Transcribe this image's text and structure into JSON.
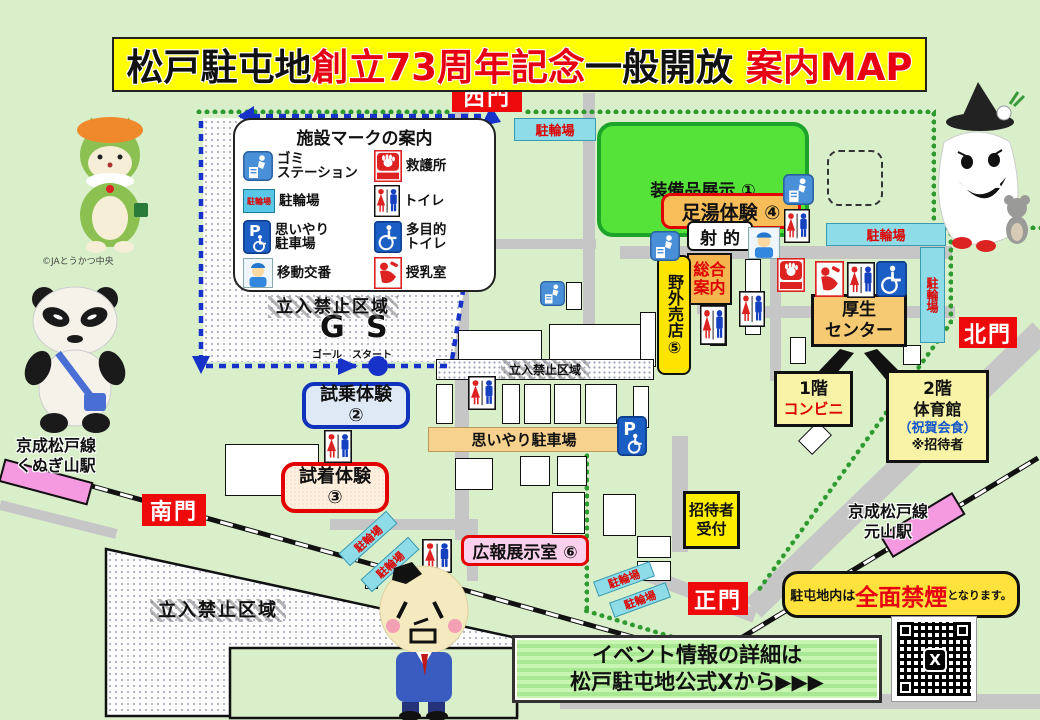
{
  "title": {
    "t1": "松戸駐屯地",
    "t2": "創立73周年記念",
    "t3": "一般開放",
    "t4": " 案内MAP"
  },
  "gates": {
    "west": "西門",
    "north": "北門",
    "south": "南門",
    "main": "正門"
  },
  "legend": {
    "title": "施設マークの案内",
    "items": [
      {
        "name": "trash-station",
        "label": "ゴミ\nステーション"
      },
      {
        "name": "first-aid",
        "label": "救護所"
      },
      {
        "name": "bicycle-parking",
        "label": "駐輪場"
      },
      {
        "name": "toilet",
        "label": "トイレ"
      },
      {
        "name": "priority-parking",
        "label": "思いやり\n駐車場"
      },
      {
        "name": "multipurpose-toilet",
        "label": "多目的\nトイレ"
      },
      {
        "name": "mobile-police",
        "label": "移動交番"
      },
      {
        "name": "nursing-room",
        "label": "授乳室"
      }
    ]
  },
  "venues": {
    "equipment_display": "装備品展示 ①",
    "test_ride": "試乗体験\n②",
    "fitting": "試着体験\n③",
    "foot_bath": "足湯体験 ④",
    "outdoor_shop": "野外売店⑤",
    "pr_exhibit": "広報展示室 ⑥",
    "shooting": "射 的",
    "info_desk": "総合\n案内",
    "welfare_center": "厚生\nセンター",
    "conv_line1": "1階",
    "conv_line2": "コンビニ",
    "gym_line1": "2階",
    "gym_line2": "体育館",
    "gym_line3": "（祝賀会食）",
    "gym_line4": "※招待者",
    "reception": "招待者\n受付",
    "priority_parking_strip": "思いやり駐車場"
  },
  "areas": {
    "restricted": "立入禁止区域",
    "bicycle": "駐輪場"
  },
  "course": {
    "goal": "G",
    "start": "S",
    "goal_label": "ゴール",
    "start_label": "スタート"
  },
  "stations": {
    "kunugiyama": "京成松戸線\nくぬぎ山駅",
    "motoyama": "京成松戸線\n元山駅"
  },
  "notices": {
    "smoke_pre": "駐屯地内は",
    "smoke_main": "全面禁煙",
    "smoke_post": "となります。",
    "event_line1": "イベント情報の詳細は",
    "event_line2": "松戸駐屯地公式Xから▶▶▶",
    "x_logo": "X"
  },
  "credits": {
    "ja": "©JAとうかつ中央"
  }
}
